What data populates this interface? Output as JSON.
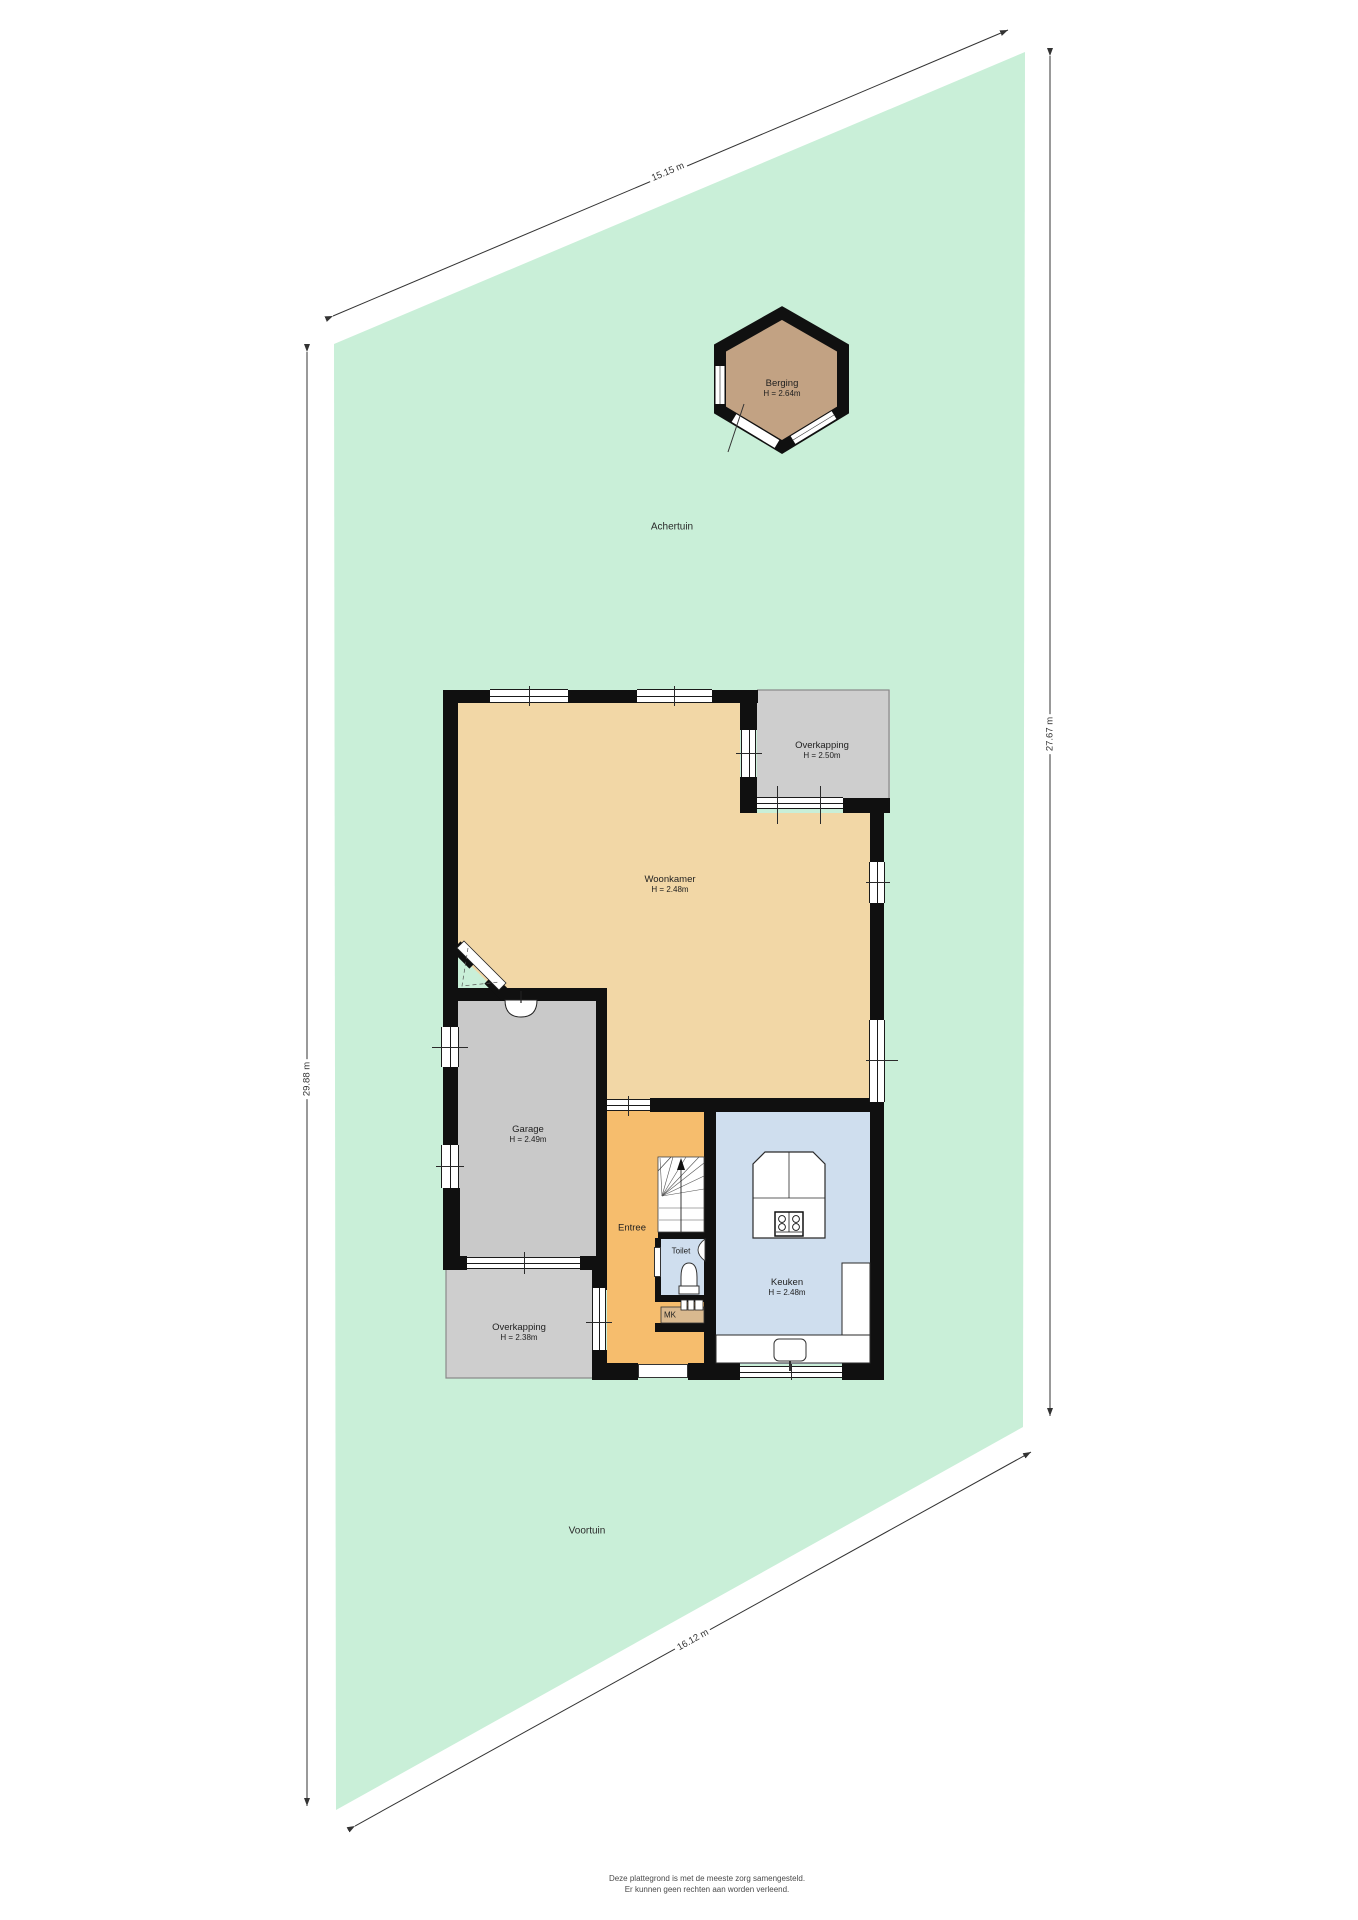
{
  "garden": {
    "back_label": "Achertuin",
    "front_label": "Voortuin"
  },
  "shed": {
    "label": "Berging",
    "height": "H = 2.64m"
  },
  "rooms": {
    "woonkamer": {
      "label": "Woonkamer",
      "height": "H = 2.48m"
    },
    "overkapping_top": {
      "label": "Overkapping",
      "height": "H = 2.50m"
    },
    "garage": {
      "label": "Garage",
      "height": "H = 2.49m"
    },
    "entree": {
      "label": "Entree"
    },
    "toilet": {
      "label": "Toilet"
    },
    "keuken": {
      "label": "Keuken",
      "height": "H = 2.48m"
    },
    "overkapping_bottom": {
      "label": "Overkapping",
      "height": "H = 2.38m"
    },
    "meterkast": {
      "label": "MK"
    }
  },
  "dimensions": {
    "top": "15.15 m",
    "right": "27.67 m",
    "left": "29.88 m",
    "bottom": "16.12 m"
  },
  "footer": {
    "line1": "Deze plattegrond is met de meeste zorg samengesteld.",
    "line2": "Er kunnen geen rechten aan worden verleend."
  },
  "colors": {
    "garden": "#c9efd8",
    "living_floor": "#f2d7a6",
    "hall_floor": "#f6bd6d",
    "kitchen_floor": "#cfdeee",
    "garage_floor": "#c9c9c9",
    "canopy_floor": "#cecece",
    "shed_floor": "#c2a283",
    "wall": "#101010"
  }
}
